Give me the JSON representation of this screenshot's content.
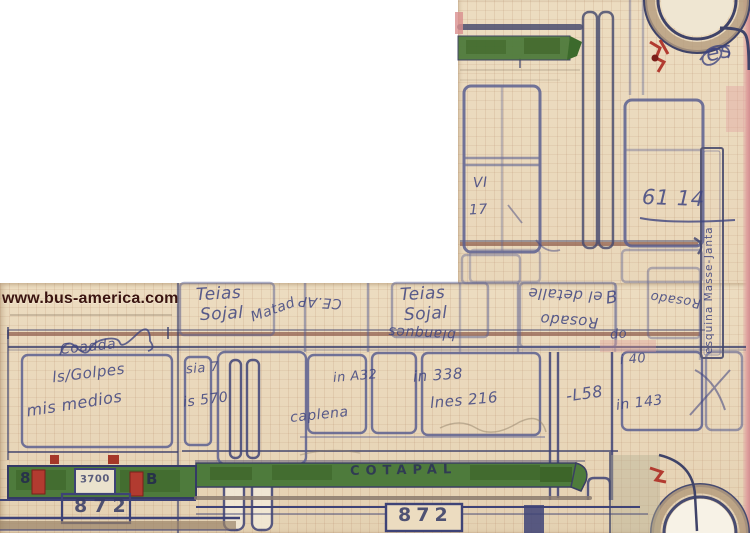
{
  "image": {
    "description": "Upside-down scanned hand-drawn sketch of a COTAPAL bus (side view with rear view at lower left) on aged graph paper",
    "watermark": "www.bus-america.com"
  },
  "bus": {
    "operator_marking": "COTAPAL",
    "fleet_number": "872",
    "rear_fleet_number": "872",
    "rear_plate": "3700"
  },
  "palette": {
    "paper": "#ecdcc0",
    "ink_navy": "#3e4377",
    "window_blue": "#5a5f91",
    "stripe_green": "#4e7b3c",
    "handrail_maroon": "#8b5a48",
    "detail_red": "#b23b30",
    "arch_tan": "#b59c7e",
    "scan_edge_pink": "#dfa09e",
    "watermark_color": "#3a1410"
  },
  "labels": [
    {
      "name": "note-teias-1",
      "text": "Teias",
      "x": 196,
      "y": 286,
      "size": 17,
      "angle": -3
    },
    {
      "name": "note-sojal-1",
      "text": "Sojal",
      "x": 200,
      "y": 306,
      "size": 17,
      "angle": -3
    },
    {
      "name": "note-matad",
      "text": "Matad",
      "x": 250,
      "y": 303,
      "size": 14,
      "angle": -20
    },
    {
      "name": "note-ceap",
      "text": "CE.AP",
      "x": 298,
      "y": 295,
      "size": 14,
      "angle": 184
    },
    {
      "name": "note-teias-2",
      "text": "Teias",
      "x": 400,
      "y": 286,
      "size": 17,
      "angle": -3
    },
    {
      "name": "note-sojal-2",
      "text": "Sojal",
      "x": 404,
      "y": 306,
      "size": 17,
      "angle": -3
    },
    {
      "name": "note-blanques",
      "text": "blanques",
      "x": 388,
      "y": 326,
      "size": 14,
      "angle": 183
    },
    {
      "name": "note-el-detalle",
      "text": "el detalle",
      "x": 528,
      "y": 287,
      "size": 15,
      "angle": 183
    },
    {
      "name": "note-rosado-1",
      "text": "Rosado",
      "x": 540,
      "y": 313,
      "size": 15,
      "angle": 184
    },
    {
      "name": "note-rosado-2",
      "text": "Rosado",
      "x": 650,
      "y": 293,
      "size": 13,
      "angle": 188
    },
    {
      "name": "note-do",
      "text": "do",
      "x": 610,
      "y": 328,
      "size": 13,
      "angle": -5
    },
    {
      "name": "note-b-loop",
      "text": "B",
      "x": 606,
      "y": 290,
      "size": 17,
      "angle": -8
    },
    {
      "name": "note-es",
      "text": "es",
      "x": 706,
      "y": 42,
      "size": 22,
      "angle": -12
    },
    {
      "name": "note-61-14",
      "text": "61 14",
      "x": 642,
      "y": 188,
      "size": 21,
      "angle": 2
    },
    {
      "name": "note-vi",
      "text": "VI",
      "x": 473,
      "y": 176,
      "size": 14,
      "angle": -3
    },
    {
      "name": "note-17",
      "text": "17",
      "x": 469,
      "y": 203,
      "size": 14,
      "angle": -3
    },
    {
      "name": "note-esquina-masse-janta",
      "text": "esquina Masse-Janta",
      "x": 704,
      "y": 152,
      "size": 10.5,
      "angle": 0,
      "vertical": true,
      "h": 202
    },
    {
      "name": "note-coadda",
      "text": "Coadda",
      "x": 60,
      "y": 340,
      "size": 14,
      "angle": -6
    },
    {
      "name": "note-ls-golpes",
      "text": "ls/Golpes",
      "x": 52,
      "y": 366,
      "size": 15,
      "angle": -7
    },
    {
      "name": "note-mis-medios",
      "text": "mis medios",
      "x": 26,
      "y": 396,
      "size": 16,
      "angle": -9
    },
    {
      "name": "note-sia-7",
      "text": "sia 7",
      "x": 186,
      "y": 362,
      "size": 13,
      "angle": -5
    },
    {
      "name": "note-is-570",
      "text": "is 570",
      "x": 183,
      "y": 393,
      "size": 14,
      "angle": -7
    },
    {
      "name": "note-in-a32",
      "text": "in A32",
      "x": 333,
      "y": 370,
      "size": 13,
      "angle": -5
    },
    {
      "name": "note-caplena",
      "text": "caplena",
      "x": 290,
      "y": 408,
      "size": 14,
      "angle": -6
    },
    {
      "name": "note-in-338",
      "text": "in 338",
      "x": 413,
      "y": 368,
      "size": 15,
      "angle": -4
    },
    {
      "name": "note-lnes-216",
      "text": "lnes 216",
      "x": 430,
      "y": 393,
      "size": 15,
      "angle": -5
    },
    {
      "name": "note-l58",
      "text": "-L58",
      "x": 566,
      "y": 386,
      "size": 16,
      "angle": -8
    },
    {
      "name": "note-in-143",
      "text": "in 143",
      "x": 616,
      "y": 396,
      "size": 14,
      "angle": -7
    },
    {
      "name": "note-i-40",
      "text": "i 40",
      "x": 620,
      "y": 353,
      "size": 13,
      "angle": -5
    },
    {
      "name": "cotapal-marking",
      "text": "COTAPAL",
      "x": 350,
      "y": 464,
      "size": 13,
      "angle": -1,
      "ls": 6,
      "color": "#2c3158",
      "weight": 700,
      "plain": true
    },
    {
      "name": "fleet-number-main",
      "text": "872",
      "x": 398,
      "y": 506,
      "size": 19,
      "angle": 0,
      "ls": 5,
      "color": "#343a66",
      "weight": 700,
      "plain": true
    },
    {
      "name": "fleet-number-rear",
      "text": "872",
      "x": 74,
      "y": 497,
      "size": 19,
      "angle": 0,
      "ls": 6,
      "color": "#343a66",
      "weight": 700,
      "plain": true
    },
    {
      "name": "rear-plate-text",
      "text": "3700",
      "x": 80,
      "y": 475,
      "size": 10,
      "angle": -2,
      "color": "#41466f",
      "weight": 700,
      "plain": true
    },
    {
      "name": "rear-mark-8",
      "text": "8",
      "x": 20,
      "y": 471,
      "size": 15,
      "angle": 0,
      "color": "#23284f",
      "weight": 700,
      "plain": true
    },
    {
      "name": "rear-mark-b",
      "text": "B",
      "x": 146,
      "y": 472,
      "size": 15,
      "angle": 0,
      "color": "#23284f",
      "weight": 700,
      "plain": true
    }
  ]
}
